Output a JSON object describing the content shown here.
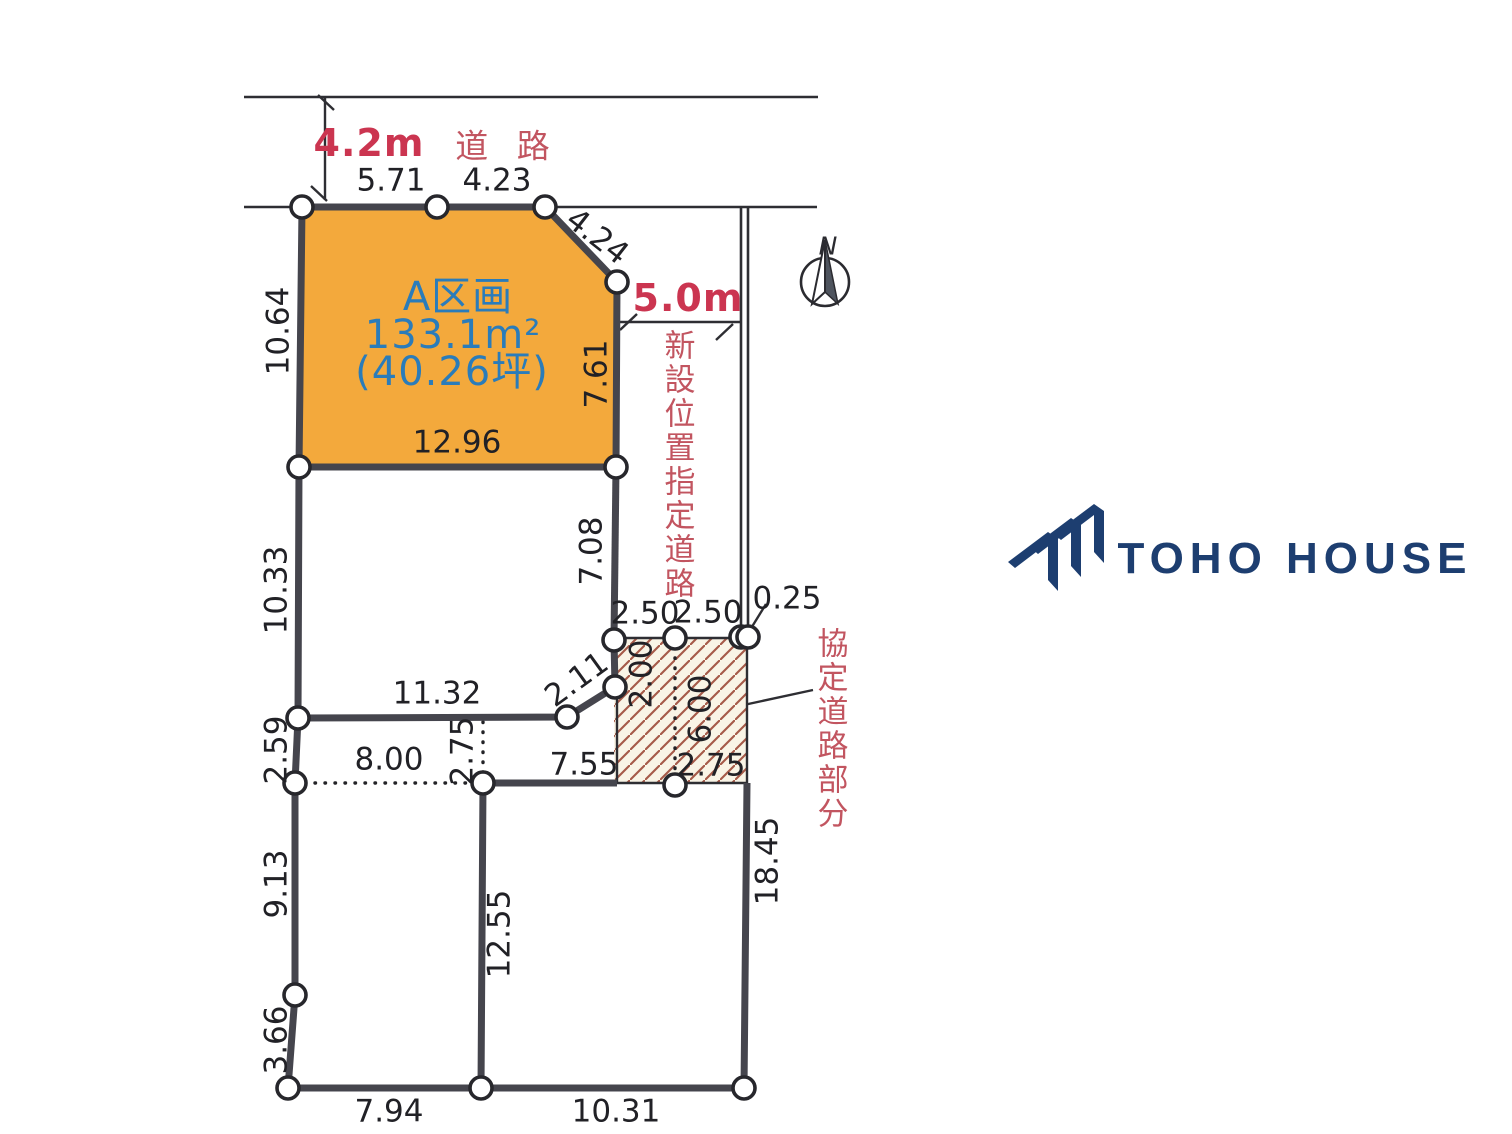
{
  "diagram": {
    "roads": {
      "top_width": "4.2m",
      "top_label": "道 路",
      "side_width": "5.0m",
      "new_road": "新設位置指定道路",
      "agreement_road": "協定道路部分"
    },
    "plot": {
      "name": "A区画",
      "area_m2": "133.1m²",
      "area_tsubo": "(40.26坪)"
    },
    "measurements": {
      "road_frontage_1": "5.71",
      "road_frontage_2": "4.23",
      "corner_cut": "4.24",
      "west_upper": "10.64",
      "east_upper": "7.61",
      "south_width": "12.96",
      "west_mid": "10.33",
      "east_mid": "7.08",
      "hatch_top_1": "2.50",
      "hatch_top_2": "2.50",
      "hatch_top_3": "0.25",
      "diag_small": "2.11",
      "hatch_west": "2.00",
      "hatch_center": "6.00",
      "mid_width": "11.32",
      "west_small": "2.59",
      "dotted_width": "8.00",
      "dotted_height": "2.75",
      "south_mid_width": "7.55",
      "hatch_bottom": "2.75",
      "west_lower": "9.13",
      "west_bottom": "3.66",
      "center_vertical": "12.55",
      "east_lower": "18.45",
      "bottom_width_1": "7.94",
      "bottom_width_2": "10.31"
    },
    "compass_n": "N"
  },
  "logo": {
    "text": "TOHO HOUSE"
  },
  "colors": {
    "plot_fill": "#f3a93c",
    "boundary": "#45454d",
    "thin_line": "#2e2e33",
    "red_bold": "#cb3550",
    "red_jp": "#c25560",
    "blue_plot_text": "#2a7cba",
    "hatch_line": "#a65a49",
    "hatch_bg": "#f9f4e6",
    "logo_navy": "#1d3e70"
  }
}
